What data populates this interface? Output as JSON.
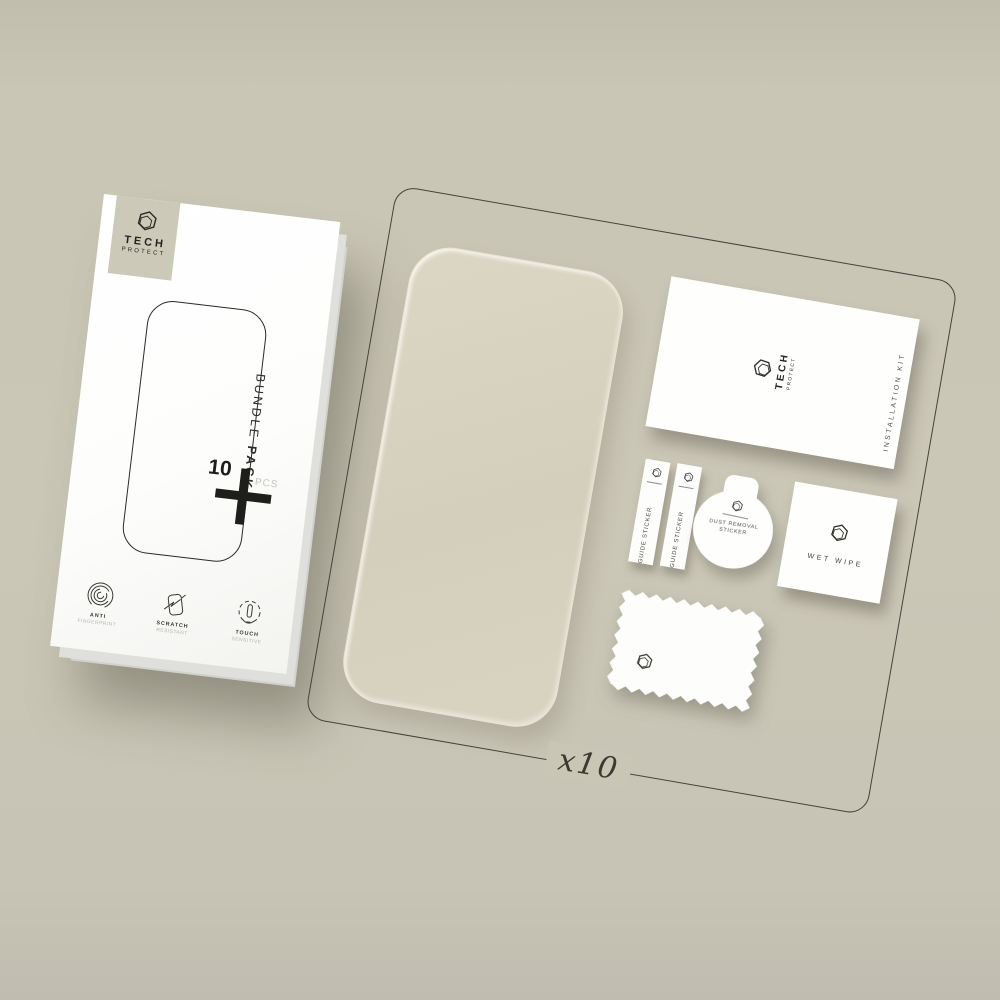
{
  "scene": {
    "count_label": "x10"
  },
  "palette": {
    "background": "#cac6b6",
    "box_white": "#fdfdfc",
    "ink": "#26251f",
    "muted_text": "#b7b5ac",
    "glass_tint": "#d6d0be",
    "frame_line": "#44433b"
  },
  "box": {
    "brand": {
      "name_top": "TECH",
      "name_bottom": "PROTECT"
    },
    "bundle_text": {
      "word_regular": "BUNDLE ",
      "word_bold": "PACK"
    },
    "quantity": {
      "number": "10",
      "unit": "PCS"
    },
    "features": [
      {
        "title": "ANTI",
        "subtitle": "FINGERPRINT"
      },
      {
        "title": "SCRATCH",
        "subtitle": "RESISTANT"
      },
      {
        "title": "TOUCH",
        "subtitle": "SENSITIVE"
      }
    ]
  },
  "kit_envelope": {
    "brand": {
      "name_top": "TECH",
      "name_bottom": "PROTECT"
    },
    "side_label": "INSTALLATION KIT"
  },
  "accessories": {
    "guide_sticker_1": "GUIDE STICKER",
    "guide_sticker_2": "GUIDE STICKER",
    "dust_sticker_line1": "DUST REMOVAL",
    "dust_sticker_line2": "STICKER",
    "wet_wipe_label": "WET WIPE"
  }
}
